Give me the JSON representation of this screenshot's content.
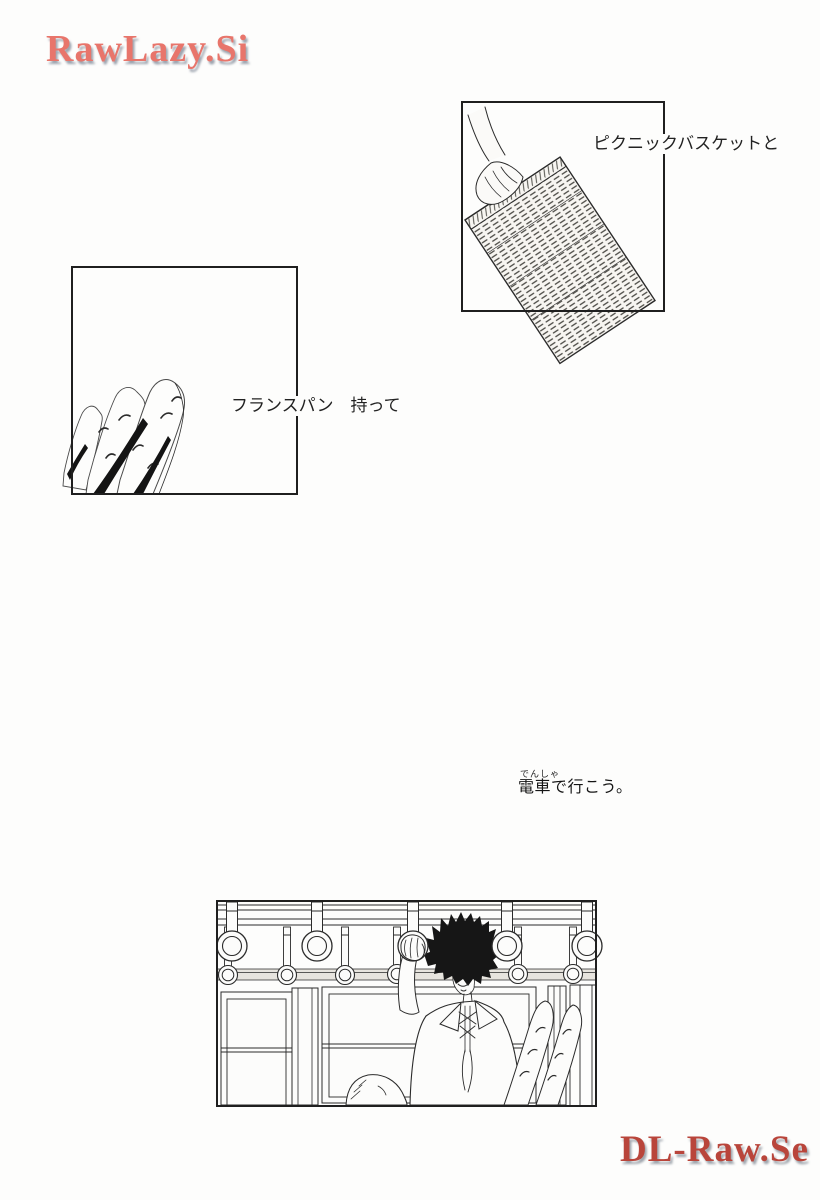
{
  "watermarks": {
    "top": {
      "text": "RawLazy.Si",
      "color": "#e8756b"
    },
    "bottom": {
      "text": "DL-Raw.Se",
      "color": "#b9453b"
    }
  },
  "captions": {
    "basket": "ピクニックバスケットと",
    "bread": "フランスパン　持って"
  },
  "narration": {
    "furigana": "でんしゃ",
    "text": "電車で行こう。"
  }
}
